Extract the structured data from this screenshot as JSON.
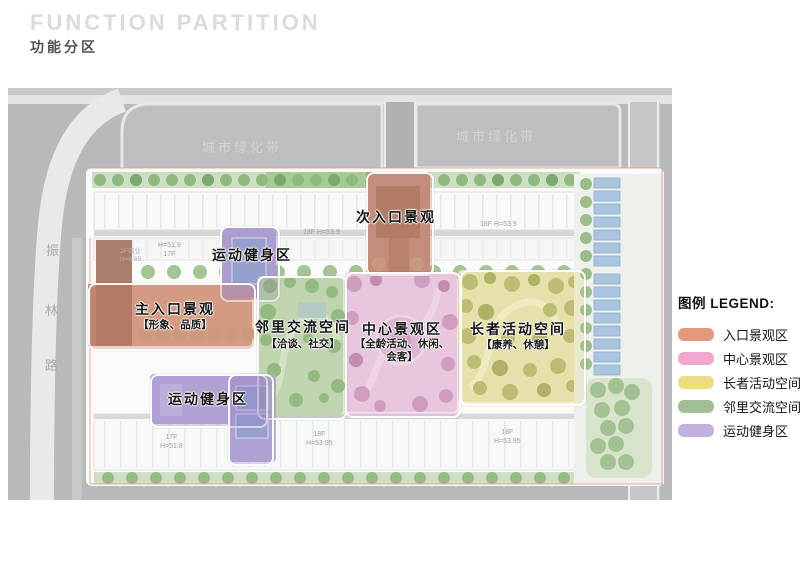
{
  "header": {
    "title_en": "FUNCTION PARTITION",
    "title_zh": "功能分区"
  },
  "map": {
    "greenbelt_labels": [
      "城市绿化带",
      "城市绿化带"
    ],
    "road_name": [
      "振",
      "林",
      "路"
    ],
    "zones": {
      "secondary_entrance": {
        "label": "次入口景观",
        "color": "#E5997B"
      },
      "fitness_upper": {
        "label": "运动健身区",
        "color": "#C2B0DE"
      },
      "main_entrance": {
        "label": "主入口景观",
        "sub": "【形象、品质】",
        "color": "#E5997B"
      },
      "neighbor": {
        "label": "邻里交流空间",
        "sub": "【洽谈、社交】",
        "color": "#A2BE99"
      },
      "central": {
        "label": "中心景观区",
        "sub_line1": "【全龄活动、休闲、",
        "sub_line2": "会客】",
        "color": "#F2A8CE"
      },
      "elder": {
        "label": "长者活动空间",
        "sub": "【康养、休憩】",
        "color": "#EDDD84"
      },
      "fitness_lower": {
        "label": "运动健身区",
        "color": "#C2B0DE"
      }
    },
    "building_labels": {
      "top_left_l1": "H=51.9",
      "top_left_l2": "17F",
      "podium_l1": "2F商业",
      "podium_l2": "H=8.65",
      "top_center": "18F H=53.9",
      "top_right": "18F H=53.9",
      "bottom_left_l1": "17F",
      "bottom_left_l2": "H=51.8",
      "bottom_center_l1": "18F",
      "bottom_center_l2": "H=53.95",
      "bottom_right_l1": "18F",
      "bottom_right_l2": "H=53.95"
    }
  },
  "legend": {
    "title": "图例 LEGEND:",
    "items": [
      {
        "label": "入口景观区",
        "color": "#E5997B"
      },
      {
        "label": "中心景观区",
        "color": "#F2A8CE"
      },
      {
        "label": "长者活动空间",
        "color": "#EDDD84"
      },
      {
        "label": "邻里交流空间",
        "color": "#A2BE99"
      },
      {
        "label": "运动健身区",
        "color": "#C2B0DE"
      }
    ]
  }
}
